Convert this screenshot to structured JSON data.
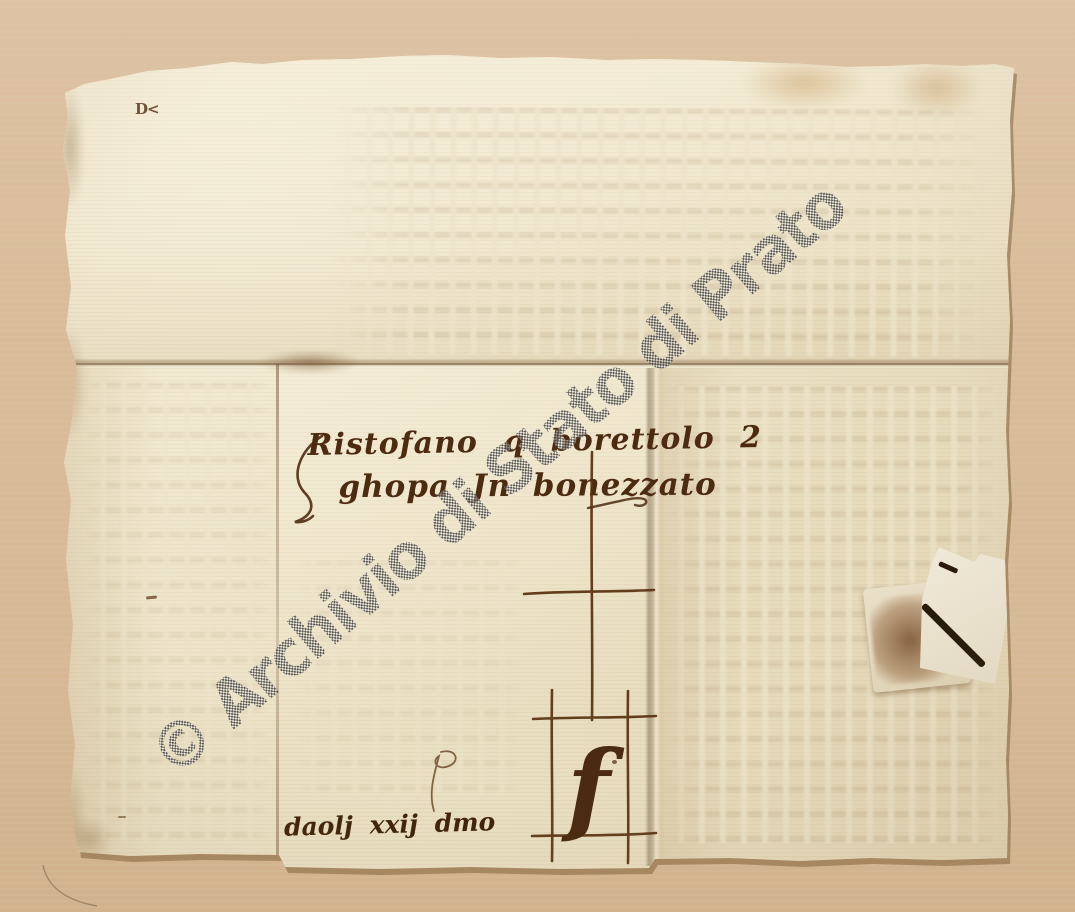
{
  "image": {
    "description": "Scanned verso of a folded medieval merchant letter with address, merchant's mark and covered wax seal",
    "background_color": "#d8bc9a",
    "paper_color": "#ece3c7",
    "ink_color": "#4c2b10",
    "seal_stain_color": "#7a4e2a"
  },
  "watermark": {
    "text": "© Archivio di Stato di Prato",
    "pattern": "gray-halftone-checkerboard",
    "color": "#4f4f4f"
  },
  "handwriting": {
    "address_line1": "Ristofano q borettolo 2",
    "address_line2": "ghopa Jn bonezzato",
    "docket_line": "daolj xxij dmo",
    "merchant_mark_letter": "f",
    "corner_mark": "D<"
  }
}
